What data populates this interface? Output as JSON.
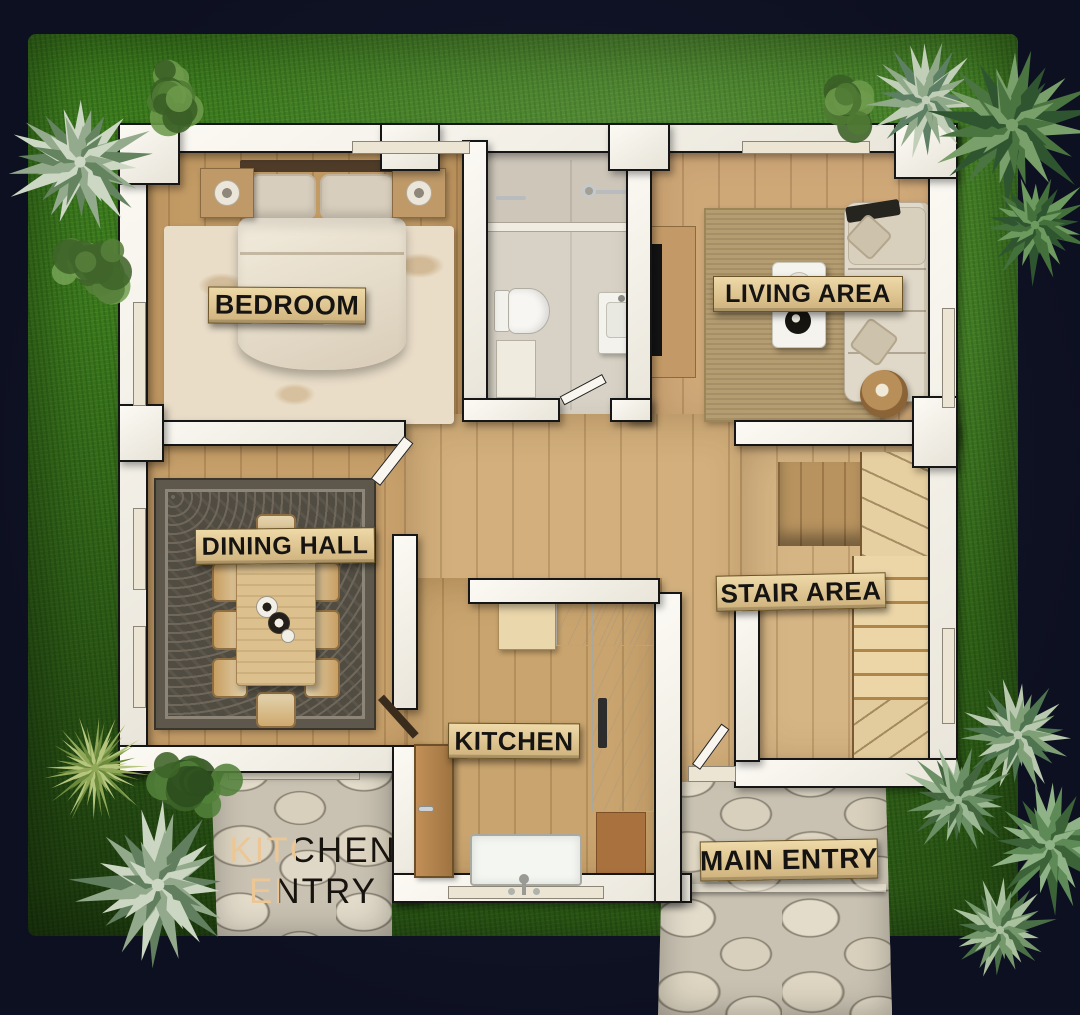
{
  "scene": {
    "type": "floor-plan-rendering",
    "background_color": "#0f1322",
    "lawn_color": "#3c7a1e",
    "wall_color": "#f5f2e8",
    "wood_color": "#cba571",
    "plaque_color": "#dfc28c",
    "stone_color": "#ccc5b5"
  },
  "rooms": {
    "bedroom": {
      "label": "BEDROOM"
    },
    "living_area": {
      "label": "LIVING AREA"
    },
    "dining_hall": {
      "label": "DINING HALL"
    },
    "stair_area": {
      "label": "STAIR AREA"
    },
    "kitchen": {
      "label": "KITCHEN"
    },
    "kitchen_entry": {
      "line1": "KITCHEN",
      "line2": "ENTRY"
    },
    "main_entry": {
      "label": "MAIN ENTRY"
    }
  }
}
